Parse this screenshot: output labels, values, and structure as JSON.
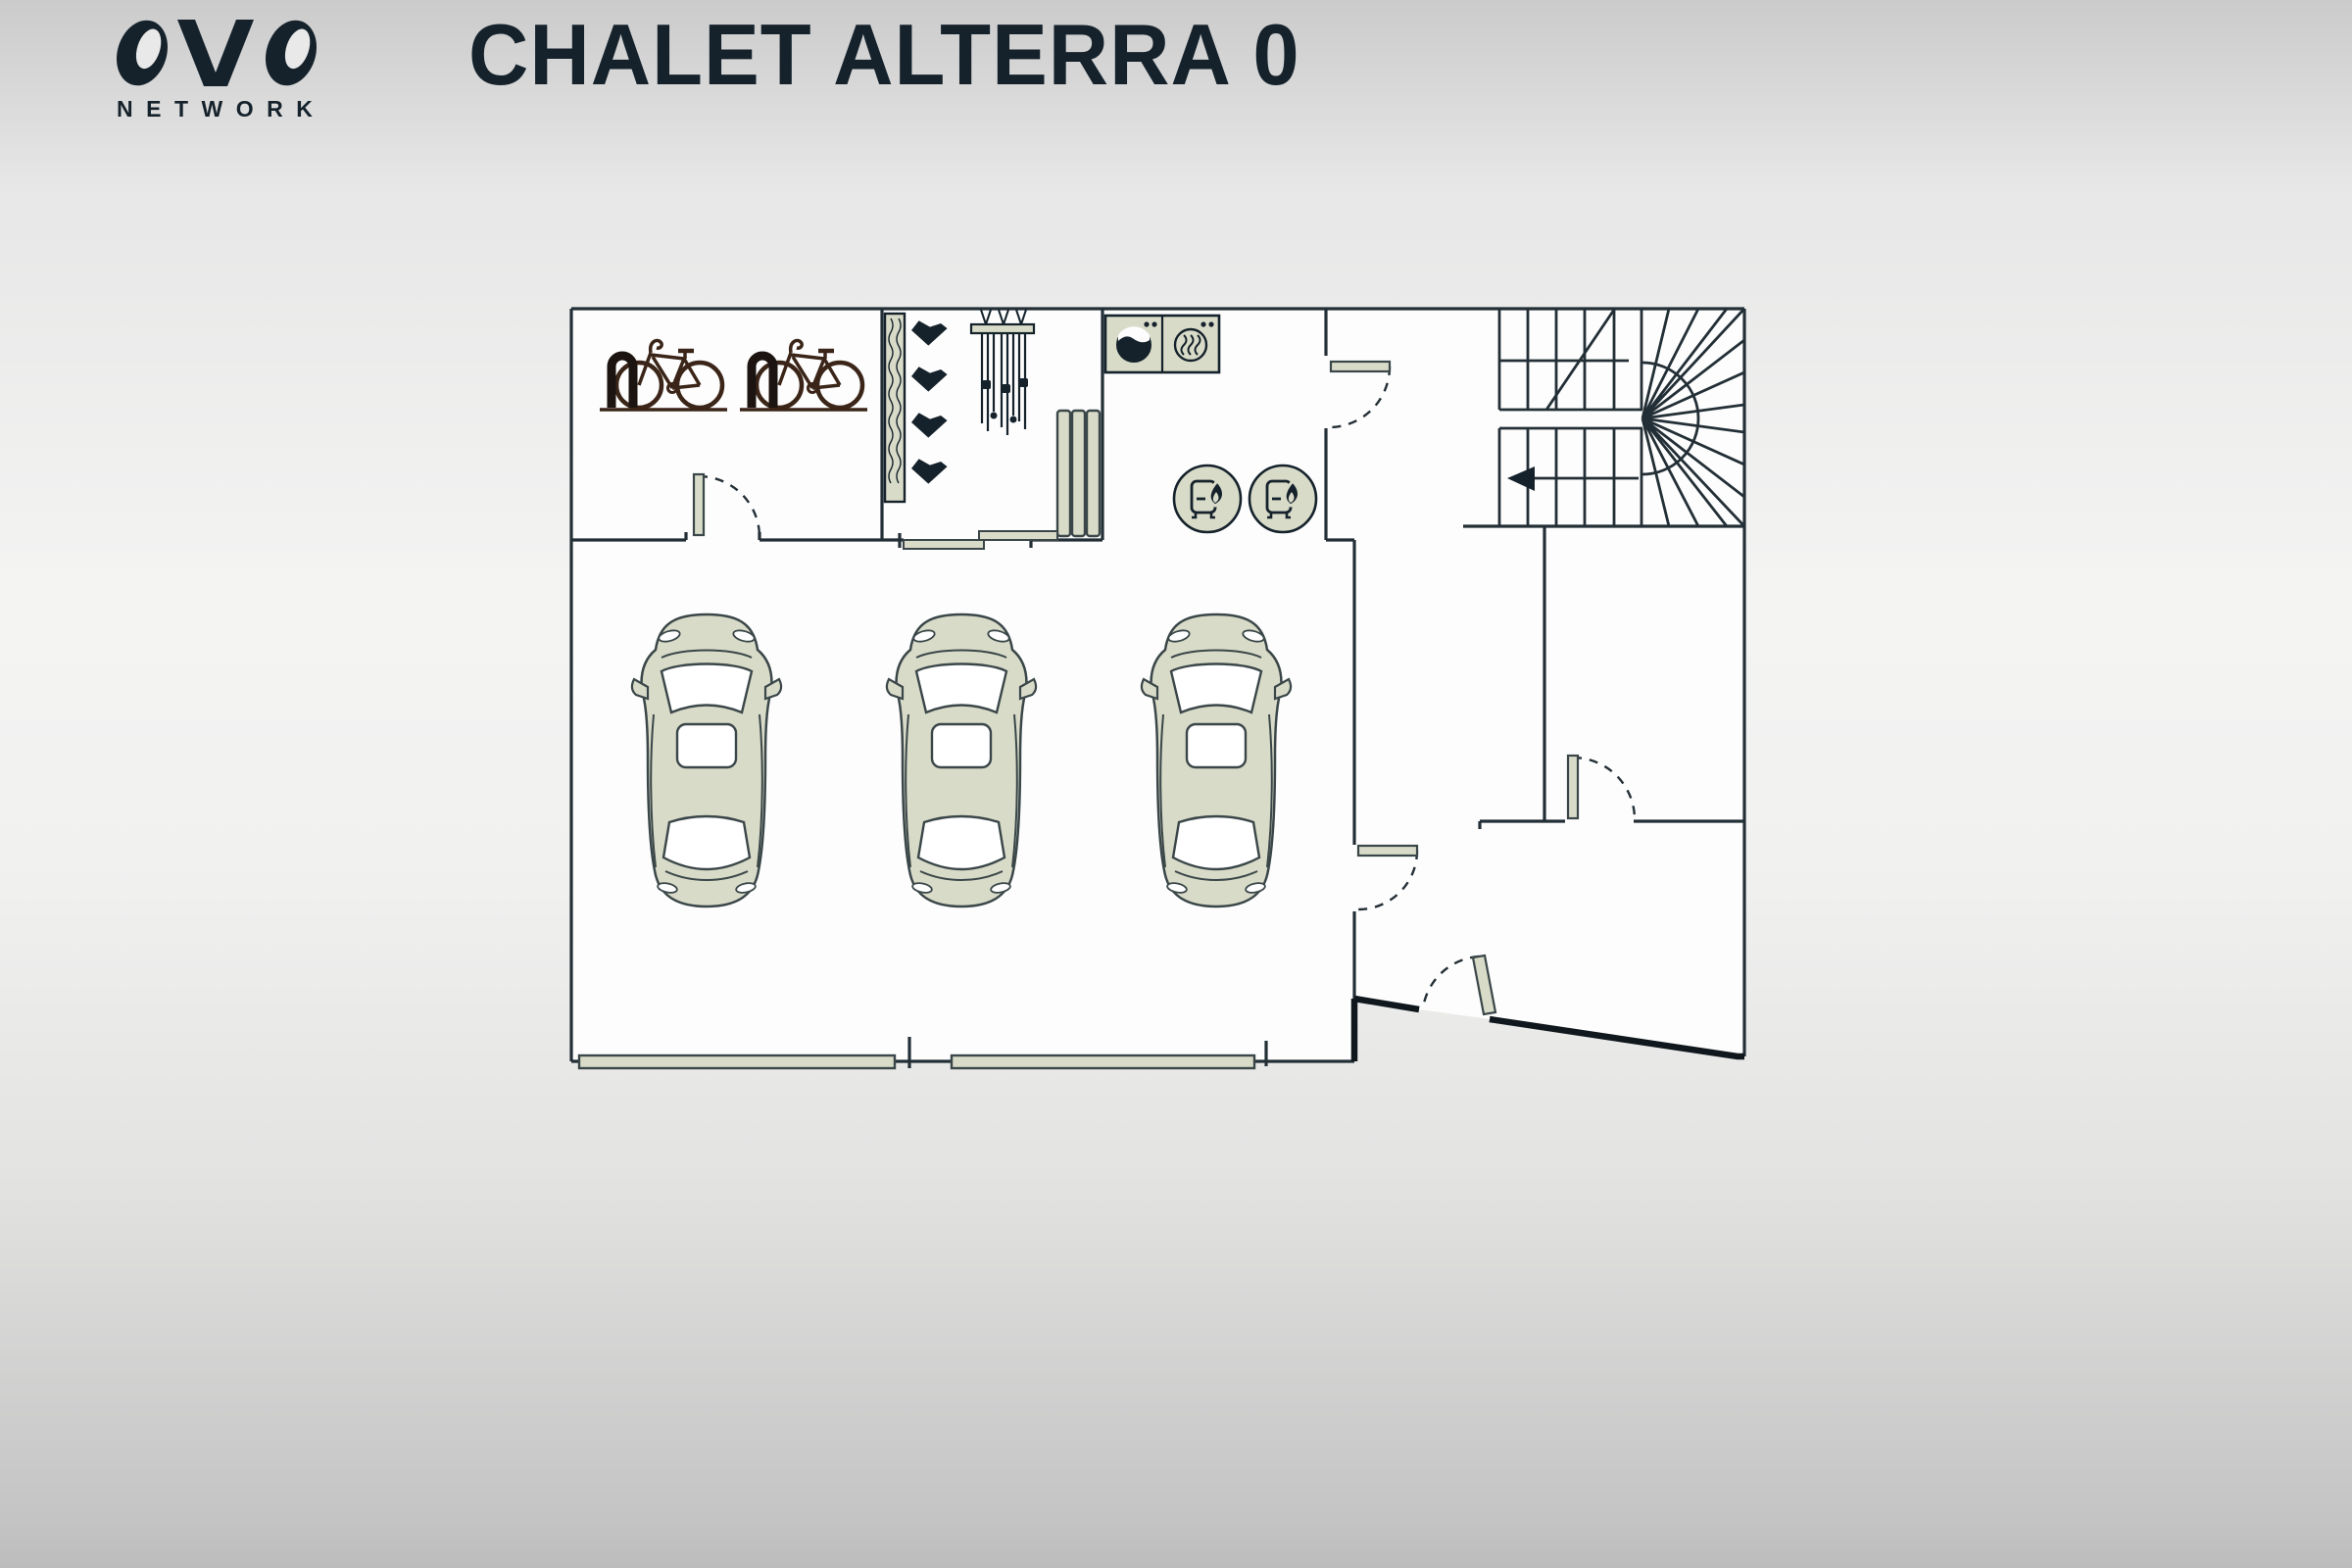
{
  "header": {
    "logo_text": "OVO",
    "logo_subtext": "NETWORK",
    "title": "CHALET ALTERRA 0"
  },
  "plan": {
    "floor_label": "0",
    "colors": {
      "wall": "#232f36",
      "thick_wall": "#10181d",
      "fixture_fill": "#d9dbc9",
      "fixture_stroke": "#3a4648",
      "bike": "#3a2518",
      "icon_dark": "#15222b",
      "floor": "#fdfdfd",
      "title": "#15222b"
    },
    "icons": [
      {
        "name": "bicycle-icon",
        "count": 2
      },
      {
        "name": "bike-rack-icon",
        "count": 2
      },
      {
        "name": "ski-boot-rack-icon",
        "count": 1
      },
      {
        "name": "ski-boot-icon",
        "count": 4
      },
      {
        "name": "ski-rack-icon",
        "count": 1
      },
      {
        "name": "radiator-icon",
        "count": 1
      },
      {
        "name": "washing-machine-icon",
        "count": 1
      },
      {
        "name": "tumble-dryer-icon",
        "count": 1
      },
      {
        "name": "water-heater-icon",
        "count": 2
      },
      {
        "name": "car-icon",
        "count": 3
      },
      {
        "name": "garage-door-icon",
        "count": 2
      },
      {
        "name": "swing-door-icon",
        "count": 5
      },
      {
        "name": "sliding-door-icon",
        "count": 1
      },
      {
        "name": "staircase-icon",
        "count": 1
      },
      {
        "name": "stair-direction-arrow-icon",
        "count": 1
      }
    ]
  }
}
